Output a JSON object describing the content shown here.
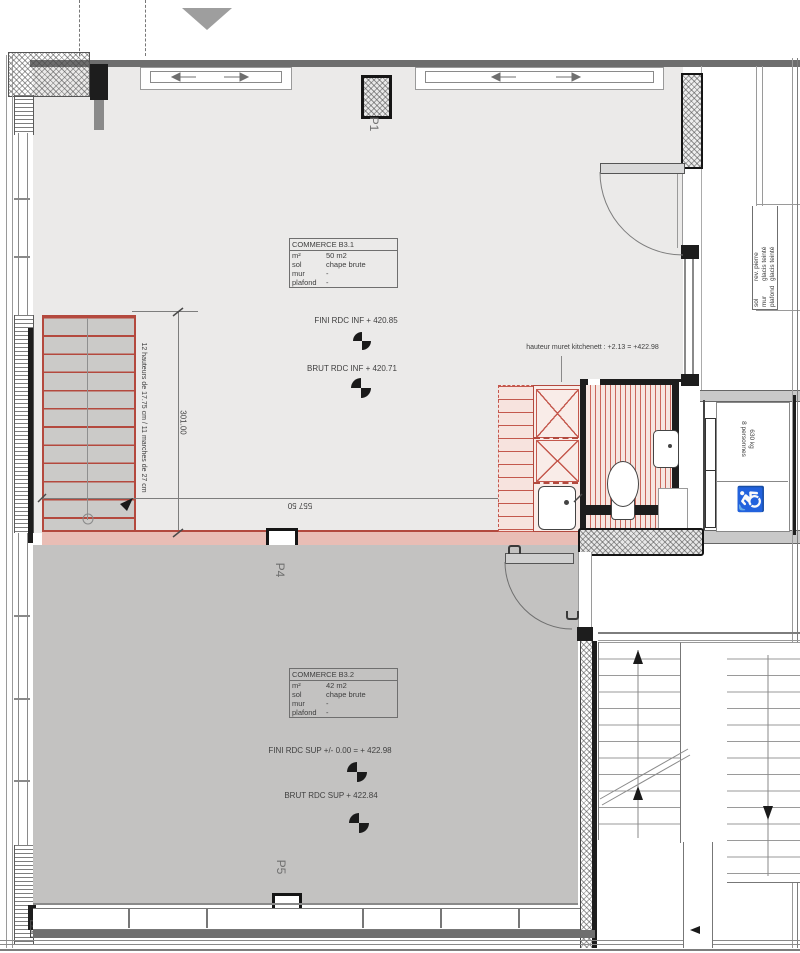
{
  "labels": {
    "p1": "P1",
    "p4": "P4",
    "p5": "P5"
  },
  "rooms": {
    "b31": {
      "name": "COMMERCE B3.1",
      "rows": [
        [
          "m²",
          "50 m2"
        ],
        [
          "sol",
          "chape brute"
        ],
        [
          "mur",
          "-"
        ],
        [
          "plafond",
          "-"
        ]
      ],
      "level_fini": "FINI RDC INF + 420.85",
      "level_brut": "BRUT RDC INF + 420.71"
    },
    "b32": {
      "name": "COMMERCE B3.2",
      "rows": [
        [
          "m²",
          "42 m2"
        ],
        [
          "sol",
          "chape brute"
        ],
        [
          "mur",
          "-"
        ],
        [
          "plafond",
          "-"
        ]
      ],
      "level_fini": "FINI RDC SUP +/- 0.00 = + 422.98",
      "level_brut": "BRUT RDC SUP + 422.84"
    }
  },
  "annotations": {
    "kitchenette": "hauteur muret kitchenett : +2.13 = +422.98",
    "stairs": "12 hauteurs de 17.75 cm / 11 marches de 27 cm",
    "dim_stairs": "301.00",
    "dim_width": "557 50"
  },
  "elevator": {
    "line1": "630 kg",
    "line2": "8 personnes"
  },
  "side_table": {
    "rows": [
      [
        "sol",
        "rev. pierre"
      ],
      [
        "mur",
        "glacis teinté"
      ],
      [
        "plafond",
        "glacis teinté"
      ]
    ]
  },
  "icons": {
    "wheelchair": "♿",
    "north_triangle": "triangle-marker",
    "level_marker": "level-marker-icon"
  },
  "colors": {
    "red_line": "#b4493e",
    "red_fill": "#e9bdb5",
    "red_hatch": "#ca675c",
    "floor_upper": "#ebeae9",
    "floor_lower": "#c3c2c1",
    "wall_dark": "#1d1d1d",
    "wall_gray": "#8a8a8a"
  }
}
